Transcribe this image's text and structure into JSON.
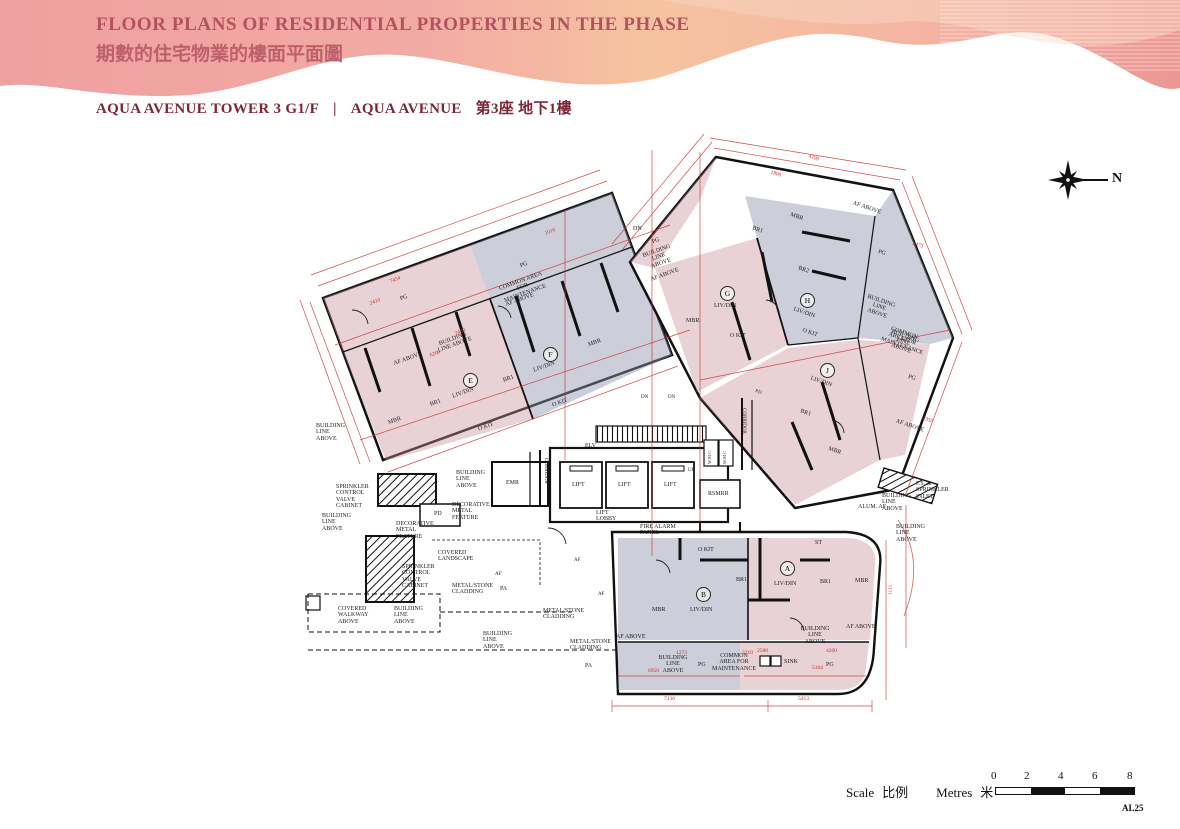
{
  "header": {
    "title_en": "FLOOR PLANS OF RESIDENTIAL PROPERTIES IN THE PHASE",
    "title_zh": "期數的住宅物業的樓面平面圖",
    "subtitle": {
      "tower": "AQUA AVENUE TOWER 3  G1/F",
      "divider": "|",
      "name_en": "AQUA AVENUE",
      "name_zh": "第3座 地下1樓"
    },
    "colors": {
      "title_en": "#b2525f",
      "title_zh": "#bd606b",
      "subtitle": "#7c2636",
      "wave_pink": "#efa0a0",
      "wave_peach": "#f6c3a0",
      "wave_rose": "#ec9693"
    }
  },
  "compass": {
    "north": "N"
  },
  "plan": {
    "colors": {
      "unit_pink": "#c98f96",
      "unit_gray": "#8f93ad",
      "dimension_red": "#c62f28",
      "wall": "#111111"
    },
    "units": {
      "a": "A",
      "b": "B",
      "e": "E",
      "f": "F",
      "g": "G",
      "h": "H",
      "j": "J"
    },
    "rooms": {
      "livdin": "LIV/DIN",
      "mbr": "MBR",
      "br1": "BR1",
      "br2": "BR2",
      "okit": "O KIT",
      "st": "ST",
      "pg": "PG"
    },
    "core": {
      "lift": "LIFT",
      "lift_lobby": "LIFT LOBBY",
      "elv": "ELV",
      "emr": "EMR",
      "rsmrr": "RSMRR",
      "wmc": "W.M.C",
      "corridor": "CORRIDOR",
      "up": "UP",
      "dn": "DN",
      "pd": "PD",
      "pa": "PA",
      "af": "AF",
      "fire_alarm": "FIRE ALARM PANEL",
      "sink": "SINK"
    },
    "annotations": {
      "building_line": "BUILDING LINE ABOVE",
      "af_above": "AF ABOVE",
      "common_area": "COMMON AREA FOR MAINTENANCE",
      "sprinkler_cabinet": "SPRINKLER CONTROL VALVE CABINET",
      "decorative_metal": "DECORATIVE METAL FEATURE",
      "covered_landscape": "COVERED LANDSCAPE",
      "covered_walkway": "COVERED WALKWAY ABOVE",
      "metal_stone": "METAL/STONE CLADDING",
      "fs_inlet": "F.S. & SPRINKLER INLET",
      "alum_af": "ALUM. AF"
    },
    "dims": [
      "7136",
      "5413",
      "6950",
      "4200",
      "2580",
      "3430",
      "2410",
      "1273",
      "2310",
      "1010",
      "1800",
      "2475",
      "4100",
      "5164",
      "2350",
      "1111",
      "7454",
      "6200"
    ]
  },
  "footer": {
    "scale_en": "Scale",
    "scale_zh": "比例",
    "metres_en": "Metres",
    "metres_zh": "米",
    "ticks": [
      "0",
      "2",
      "4",
      "6",
      "8"
    ],
    "page_code": "AL25"
  }
}
